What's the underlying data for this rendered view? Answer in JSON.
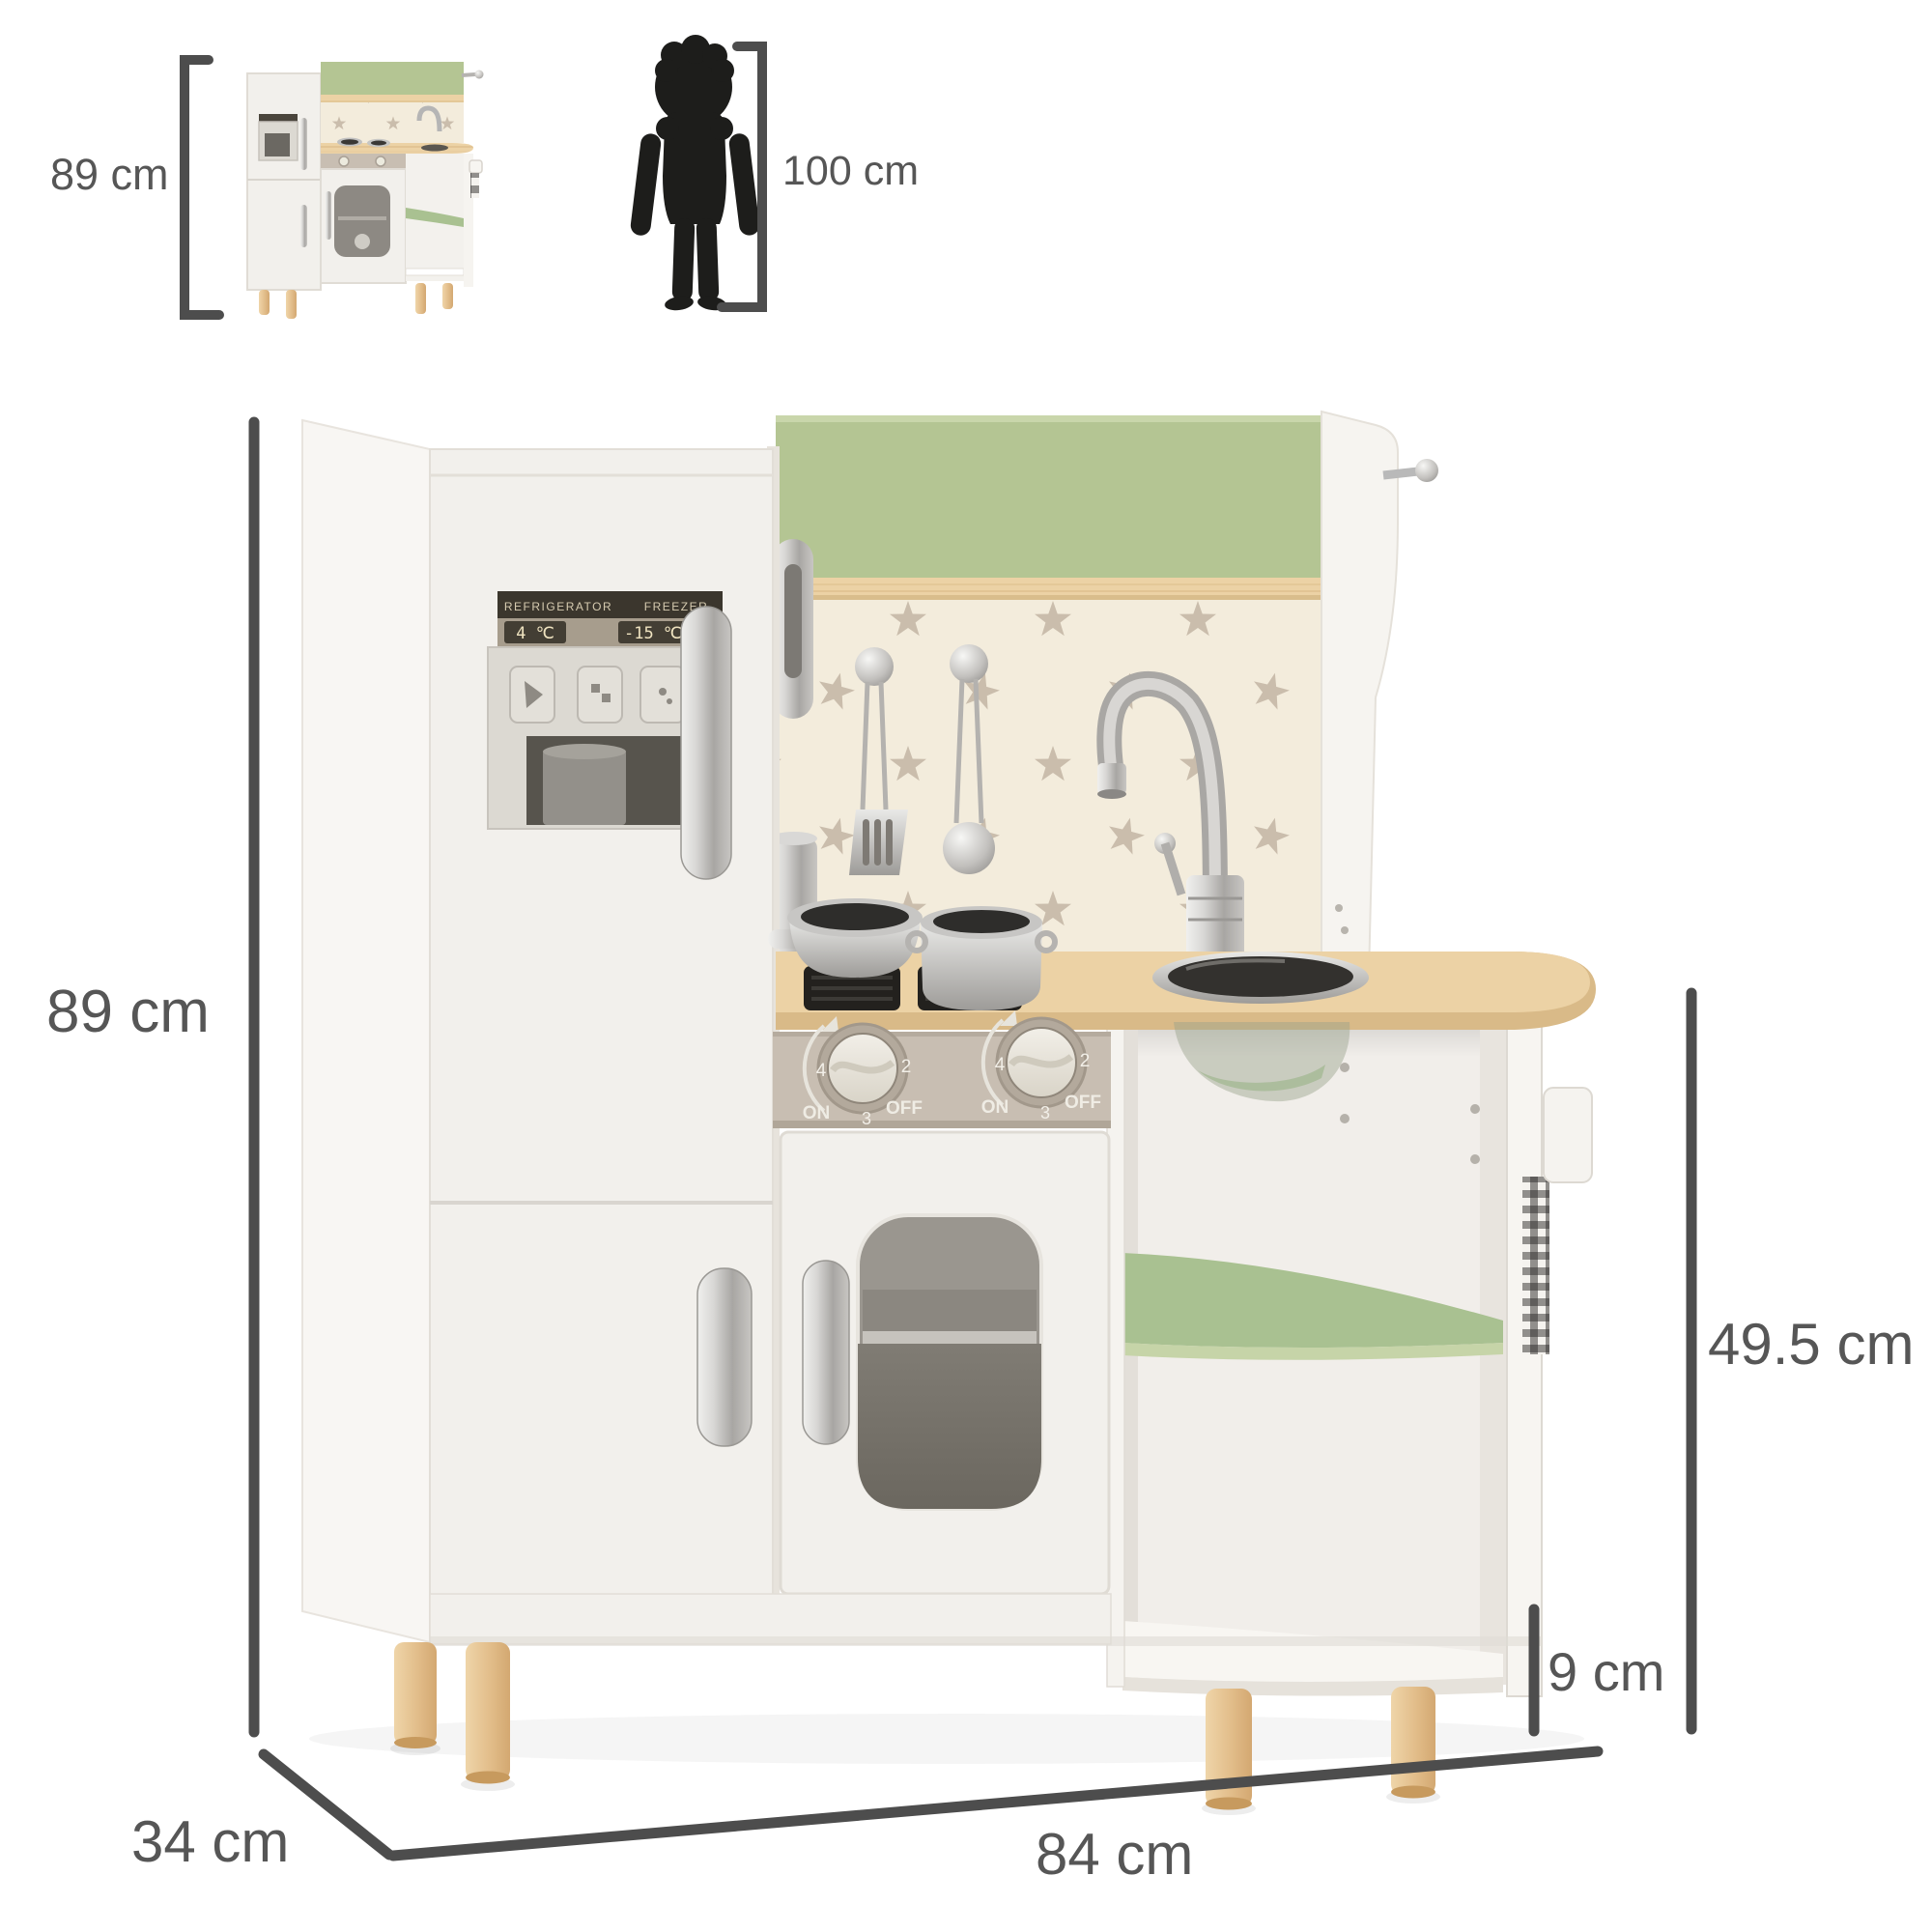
{
  "annotations": {
    "thumb_height_label": "89 cm",
    "child_height_label": "100 cm",
    "height_label": "89 cm",
    "counter_height_label": "49.5 cm",
    "leg_height_label": "9 cm",
    "depth_label": "34 cm",
    "width_label": "84 cm"
  },
  "product": {
    "fridge_panel": {
      "refrigerator_label": "REFRIGERATOR",
      "freezer_label": "FREEZER",
      "refrigerator_temp": "4 ℃",
      "freezer_temp": "-15 ℃"
    },
    "stove_knob": {
      "on": "ON",
      "off": "OFF",
      "n2": "2",
      "n3": "3",
      "n4": "4"
    }
  },
  "colors": {
    "accent_green": "#b4c593",
    "shelf_green": "#a9c191",
    "wood": "#ecd2a5",
    "leg_wood": "#e3bd8a",
    "body_white": "#f2f0ec",
    "backsplash_cream": "#f3ecdc",
    "star_gray": "#cabdac",
    "silver": "#c0c0c0",
    "dimension_gray": "#4d4d4d",
    "silhouette_black": "#1d1d1b"
  }
}
